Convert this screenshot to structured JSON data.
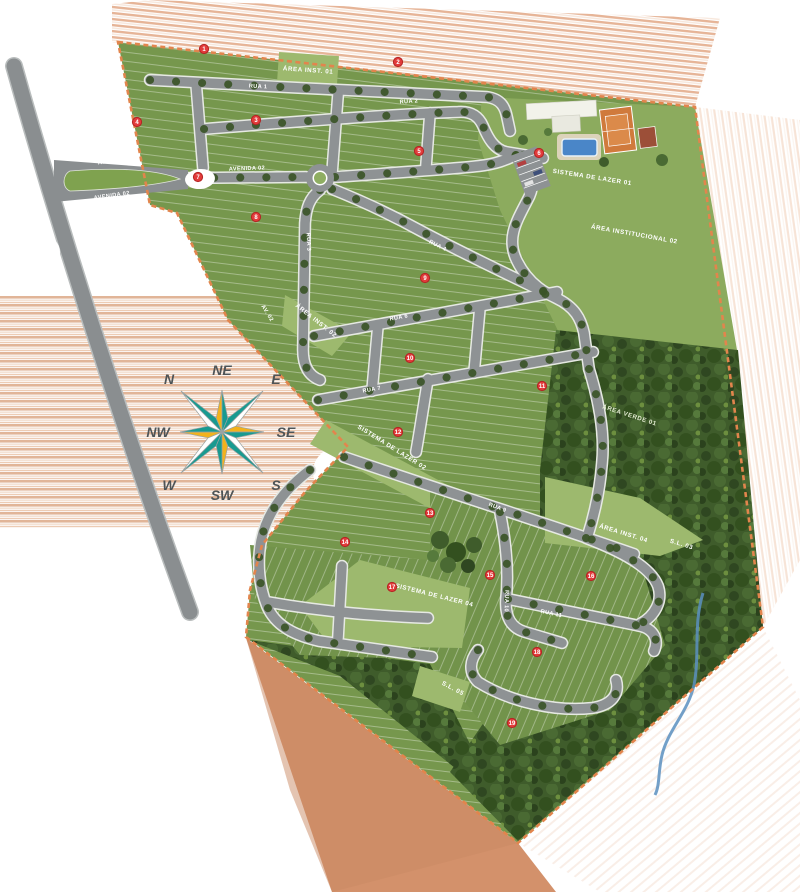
{
  "map": {
    "type": "residential-masterplan-siteplan",
    "colors": {
      "lawn": "#76974d",
      "lawn_light": "#9db96e",
      "forest": "#3f5c2b",
      "street": "#8e9294",
      "boundary": "#e2854d",
      "marker_red": "#e23b3b",
      "pool_blue": "#4a86c8",
      "court_orange": "#d07a3c",
      "compass_teal": "#189a90",
      "compass_yellow": "#f2b21d",
      "outside_salmon": "#d3916b",
      "creek_blue": "#5b8fc0"
    }
  },
  "compass": {
    "directions": [
      "N",
      "NE",
      "E",
      "SE",
      "S",
      "SW",
      "W",
      "NW"
    ]
  },
  "street_labels": [
    {
      "label": "RUA 1"
    },
    {
      "label": "RUA 2"
    },
    {
      "label": "RUA 3"
    },
    {
      "label": "RUA 4"
    },
    {
      "label": "RUA 6"
    },
    {
      "label": "RUA 7"
    },
    {
      "label": "RUA 9"
    },
    {
      "label": "RUA 10"
    },
    {
      "label": "RUA 11"
    },
    {
      "label": "AVENIDA 01"
    },
    {
      "label": "AVENIDA 02"
    },
    {
      "label": "AVENIDA 02"
    },
    {
      "label": "AV. 02"
    }
  ],
  "area_labels": [
    {
      "label": "ÁREA INST. 01"
    },
    {
      "label": "SISTEMA DE LAZER 01"
    },
    {
      "label": "ÁREA INSTITUCIONAL 02"
    },
    {
      "label": "ÁREA INST. 02"
    },
    {
      "label": "ÁREA VERDE 01"
    },
    {
      "label": "SISTEMA DE LAZER 02"
    },
    {
      "label": "ÁREA INST. 04"
    },
    {
      "label": "S.L. 03"
    },
    {
      "label": "SISTEMA DE LAZER 04"
    },
    {
      "label": "S.L. 05"
    }
  ],
  "markers": [
    {
      "label": "1"
    },
    {
      "label": "2"
    },
    {
      "label": "3"
    },
    {
      "label": "4"
    },
    {
      "label": "5"
    },
    {
      "label": "6"
    },
    {
      "label": "7"
    },
    {
      "label": "8"
    },
    {
      "label": "9"
    },
    {
      "label": "10"
    },
    {
      "label": "11"
    },
    {
      "label": "12"
    },
    {
      "label": "13"
    },
    {
      "label": "14"
    },
    {
      "label": "15"
    },
    {
      "label": "16"
    },
    {
      "label": "17"
    },
    {
      "label": "18"
    },
    {
      "label": "19"
    }
  ]
}
